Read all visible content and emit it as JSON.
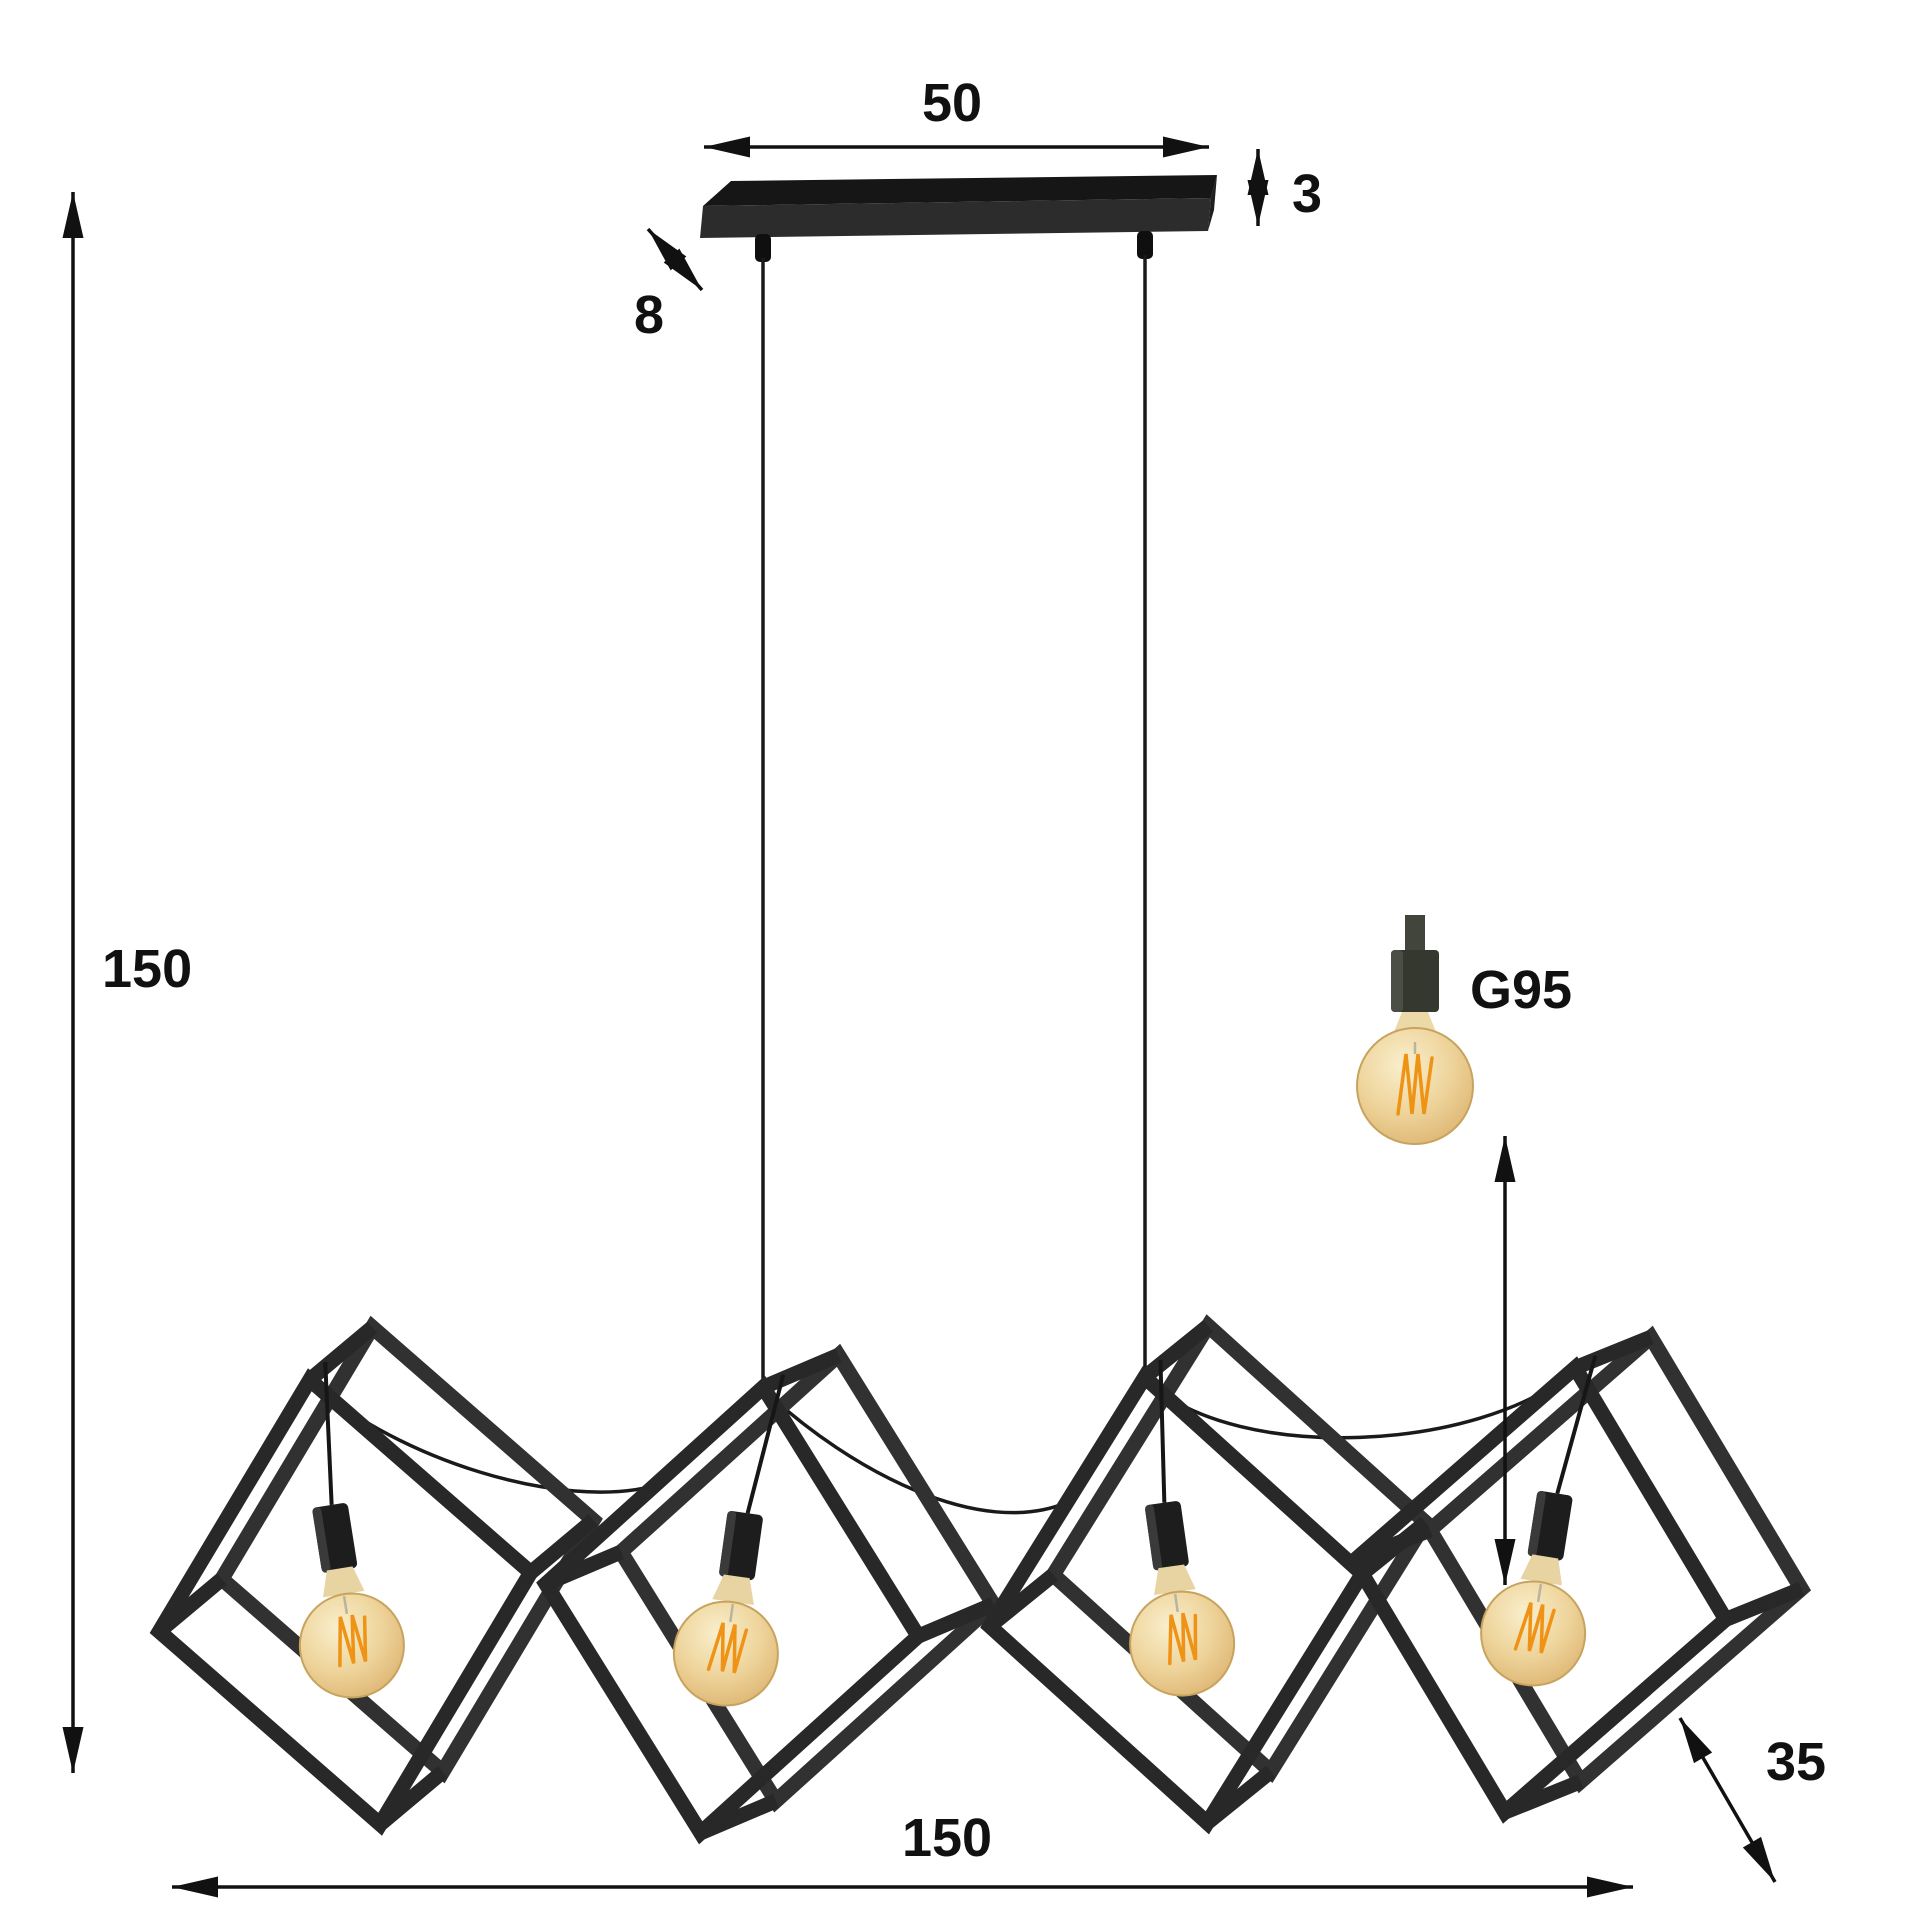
{
  "diagram": {
    "description": "Pendant lamp with 4 open metal cube frames hanging from a ceiling bar, with dimension arrows",
    "lights_count": 4
  },
  "dimensions": {
    "canopy_width": "50",
    "canopy_thickness": "3",
    "canopy_depth": "8",
    "overall_height": "150",
    "overall_width": "150",
    "overall_depth": "35"
  },
  "bulb": {
    "type": "G95"
  },
  "colors": {
    "background": "#ffffff",
    "frame": "#282828",
    "canopy_top": "#161616",
    "canopy_front": "#2c2c2c",
    "dimension": "#111111",
    "bulb_glass": "#eed49b",
    "filament": "#ef9316",
    "socket": "#34382f"
  }
}
